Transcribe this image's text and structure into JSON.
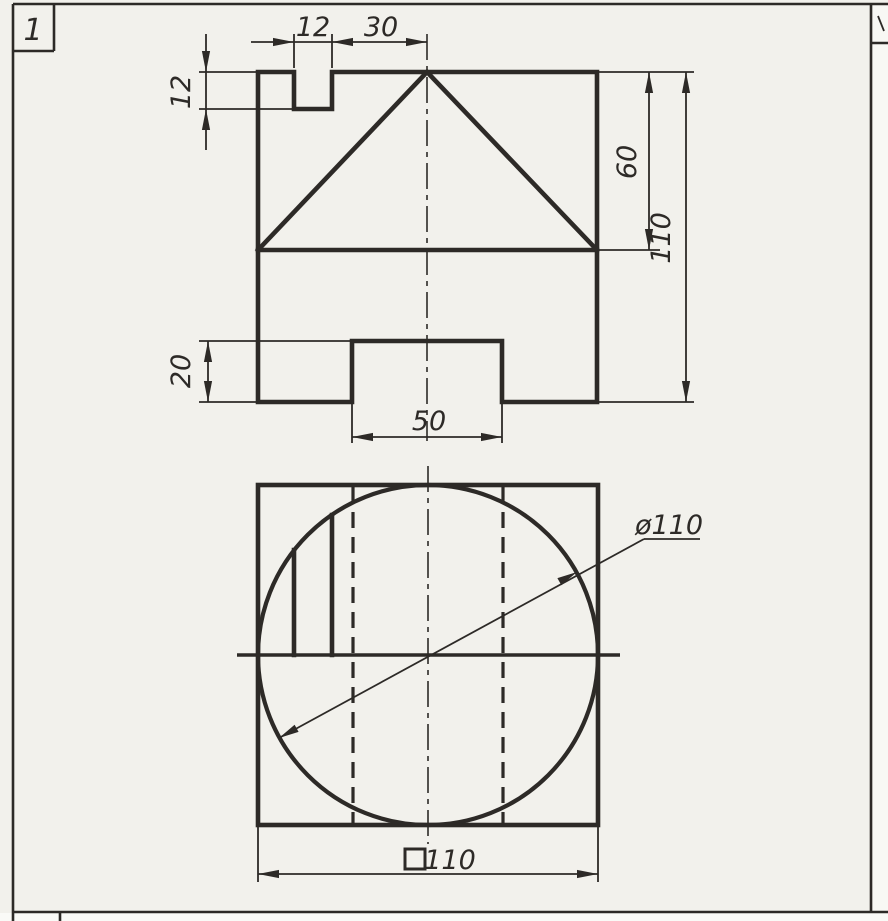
{
  "sheet": {
    "cell_label": "1",
    "paper_color": "#f2f1ec",
    "margin_paper_color": "#f8f8f4",
    "ink_color": "#2d2a27"
  },
  "front_view": {
    "dims": {
      "notch_width": "12",
      "notch_to_axis": "30",
      "notch_depth": "12",
      "cone_height": "60",
      "overall_height": "110",
      "slot_depth": "20",
      "slot_width": "50"
    }
  },
  "top_view": {
    "dims": {
      "circle_diameter": "ø110",
      "square_size": "110",
      "square_symbol_icon": "square-outline"
    }
  }
}
